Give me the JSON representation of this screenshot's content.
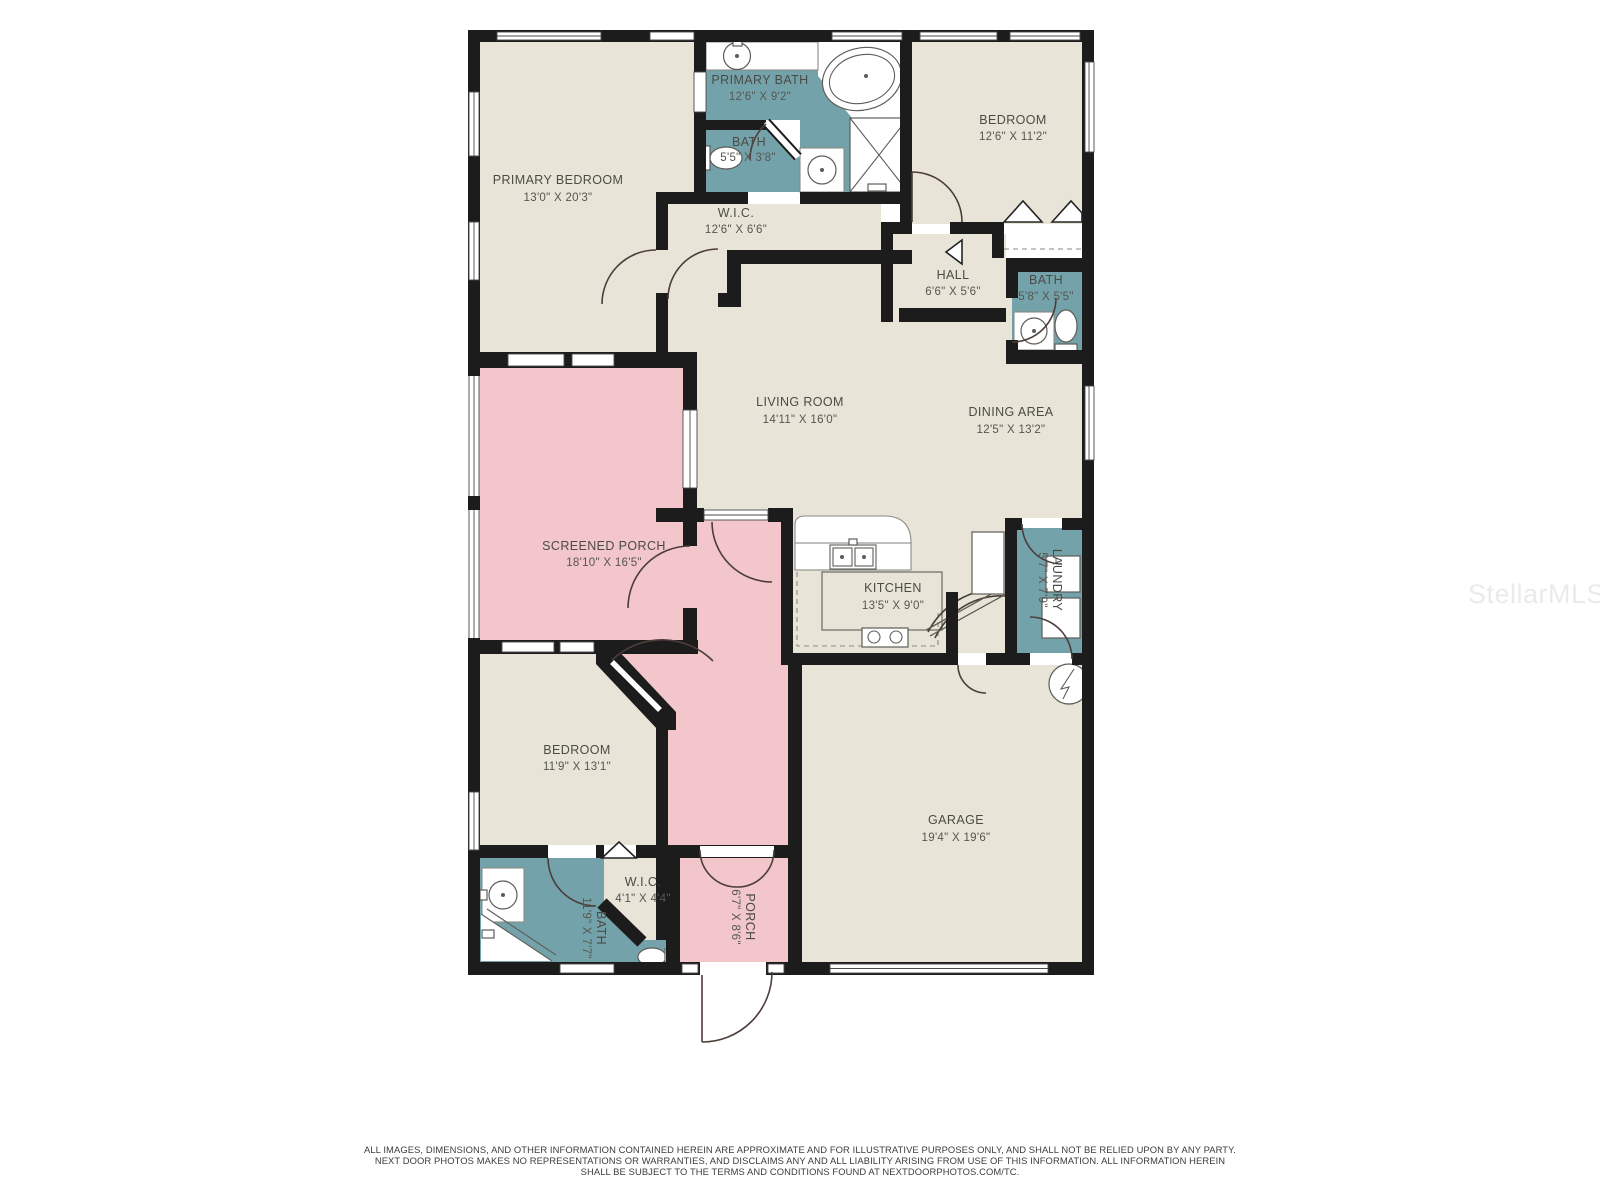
{
  "plan": {
    "watermark": "StellarMLS",
    "colors": {
      "floor": "#e8e5d8",
      "wet": "#74a2ab",
      "porch": "#f2c6ca",
      "wall": "#1c1c1c"
    },
    "rooms": [
      {
        "id": "primary-bedroom",
        "name": "PRIMARY BEDROOM",
        "dims": "13'0\" X 20'3\""
      },
      {
        "id": "primary-bath",
        "name": "PRIMARY BATH",
        "dims": "12'6\" X 9'2\""
      },
      {
        "id": "bath-wc",
        "name": "BATH",
        "dims": "5'5\" X 3'8\""
      },
      {
        "id": "bedroom-2",
        "name": "BEDROOM",
        "dims": "12'6\" X 11'2\""
      },
      {
        "id": "wic-primary",
        "name": "W.I.C.",
        "dims": "12'6\" X 6'6\""
      },
      {
        "id": "hall",
        "name": "HALL",
        "dims": "6'6\" X 5'6\""
      },
      {
        "id": "bath-2",
        "name": "BATH",
        "dims": "5'8\" X 5'5\""
      },
      {
        "id": "living-room",
        "name": "LIVING ROOM",
        "dims": "14'11\" X 16'0\""
      },
      {
        "id": "dining-area",
        "name": "DINING AREA",
        "dims": "12'5\" X 13'2\""
      },
      {
        "id": "screened-porch",
        "name": "SCREENED PORCH",
        "dims": "18'10\" X 16'5\""
      },
      {
        "id": "kitchen",
        "name": "KITCHEN",
        "dims": "13'5\" X 9'0\""
      },
      {
        "id": "laundry",
        "name": "LAUNDRY",
        "dims": "5'7\" X 7'9\""
      },
      {
        "id": "bedroom-3",
        "name": "BEDROOM",
        "dims": "11'9\" X 13'1\""
      },
      {
        "id": "wic-2",
        "name": "W.I.C.",
        "dims": "4'1\" X 4'4\""
      },
      {
        "id": "bath-3",
        "name": "BATH",
        "dims": "11'9\" X 7'7\""
      },
      {
        "id": "porch",
        "name": "PORCH",
        "dims": "6'7\" X 8'6\""
      },
      {
        "id": "garage",
        "name": "GARAGE",
        "dims": "19'4\" X 19'6\""
      }
    ],
    "disclaimer": {
      "line1": "ALL IMAGES, DIMENSIONS, AND OTHER INFORMATION CONTAINED HEREIN ARE APPROXIMATE AND FOR ILLUSTRATIVE PURPOSES ONLY, AND SHALL NOT BE RELIED UPON BY ANY PARTY.",
      "line2": "NEXT DOOR PHOTOS MAKES NO REPRESENTATIONS OR WARRANTIES, AND DISCLAIMS ANY AND ALL LIABILITY ARISING FROM USE OF THIS INFORMATION. ALL INFORMATION HEREIN",
      "line3": "SHALL BE SUBJECT TO THE TERMS AND CONDITIONS FOUND AT NEXTDOORPHOTOS.COM/TC."
    }
  }
}
